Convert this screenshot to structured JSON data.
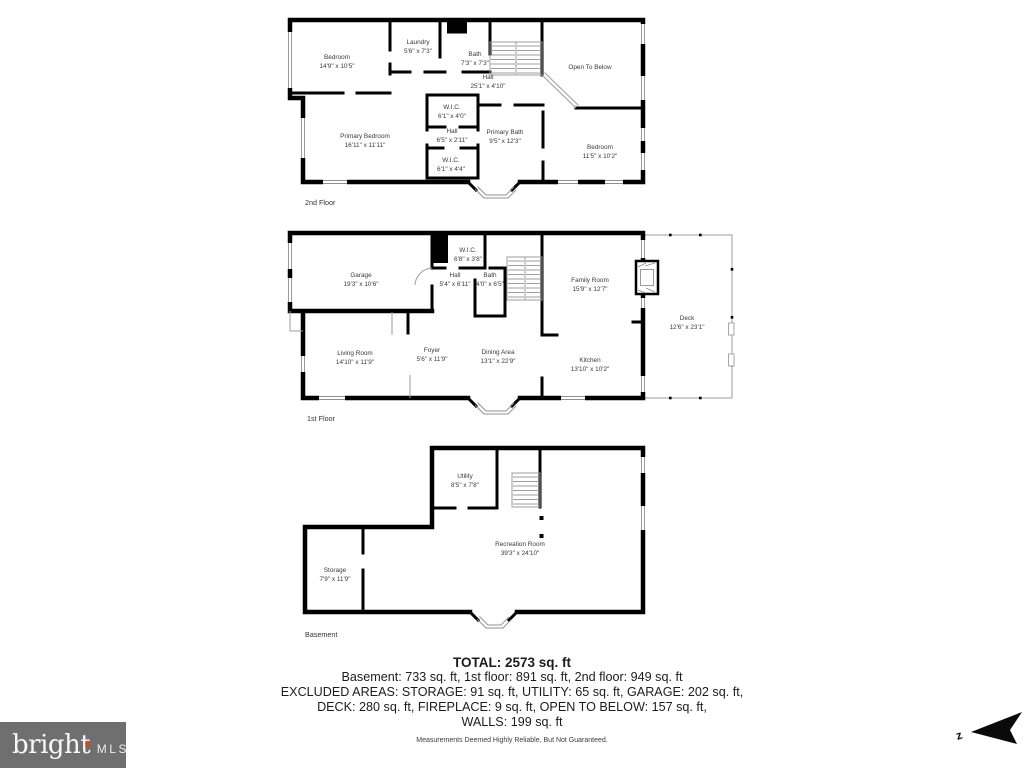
{
  "floors": {
    "second": {
      "label": "2nd Floor",
      "rooms": [
        {
          "name": "Bedroom",
          "dims": "14'9\" x 10'5\""
        },
        {
          "name": "Laundry",
          "dims": "5'6\" x 7'3\""
        },
        {
          "name": "Bath",
          "dims": "7'3\" x 7'3\""
        },
        {
          "name": "Hall",
          "dims": "25'1\" x 4'10\""
        },
        {
          "name": "Open To Below",
          "dims": ""
        },
        {
          "name": "W.I.C.",
          "dims": "6'1\" x 4'0\""
        },
        {
          "name": "Hall",
          "dims": "6'5\" x 2'11\""
        },
        {
          "name": "W.I.C.",
          "dims": "6'1\" x 4'4\""
        },
        {
          "name": "Primary Bedroom",
          "dims": "16'11\" x 11'11\""
        },
        {
          "name": "Primary Bath",
          "dims": "9'5\" x 12'3\""
        },
        {
          "name": "Bedroom",
          "dims": "11'5\" x 10'2\""
        }
      ]
    },
    "first": {
      "label": "1st Floor",
      "rooms": [
        {
          "name": "Garage",
          "dims": "19'3\" x 10'6\""
        },
        {
          "name": "W.I.C.",
          "dims": "6'8\" x 3'8\""
        },
        {
          "name": "Hall",
          "dims": "5'4\" x 6'11\""
        },
        {
          "name": "Bath",
          "dims": "4'0\" x 6'5\""
        },
        {
          "name": "Family Room",
          "dims": "15'9\" x 12'7\""
        },
        {
          "name": "Deck",
          "dims": "12'6\" x 23'1\""
        },
        {
          "name": "Living Room",
          "dims": "14'10\" x 11'9\""
        },
        {
          "name": "Foyer",
          "dims": "5'6\" x 11'9\""
        },
        {
          "name": "Dining Area",
          "dims": "13'1\" x 22'9\""
        },
        {
          "name": "Kitchen",
          "dims": "13'10\" x 10'2\""
        }
      ]
    },
    "basement": {
      "label": "Basement",
      "rooms": [
        {
          "name": "Utility",
          "dims": "8'5\" x 7'8\""
        },
        {
          "name": "Recreation Room",
          "dims": "39'3\" x 24'10\""
        },
        {
          "name": "Storage",
          "dims": "7'9\" x 11'9\""
        }
      ]
    }
  },
  "summary": {
    "total": "TOTAL: 2573 sq. ft",
    "floors_line": "Basement: 733 sq. ft, 1st floor: 891 sq. ft, 2nd floor: 949 sq. ft",
    "excluded_line1": "EXCLUDED AREAS: STORAGE: 91 sq. ft, UTILITY: 65 sq. ft, GARAGE: 202 sq. ft,",
    "excluded_line2": "DECK: 280 sq. ft, FIREPLACE: 9 sq. ft, OPEN TO BELOW: 157 sq. ft,",
    "excluded_line3": "WALLS: 199 sq. ft",
    "disclaimer": "Measurements Deemed Highly Reliable, But Not Guaranteed."
  },
  "branding": {
    "name": "bright",
    "suffix": "MLS",
    "star": "✱"
  },
  "compass": {
    "north_label": "z"
  },
  "colors": {
    "wall": "#000000",
    "logo_bg": "#6f6f6f",
    "logo_star": "#cf4a2b",
    "deck_line": "#9e9e9e"
  }
}
